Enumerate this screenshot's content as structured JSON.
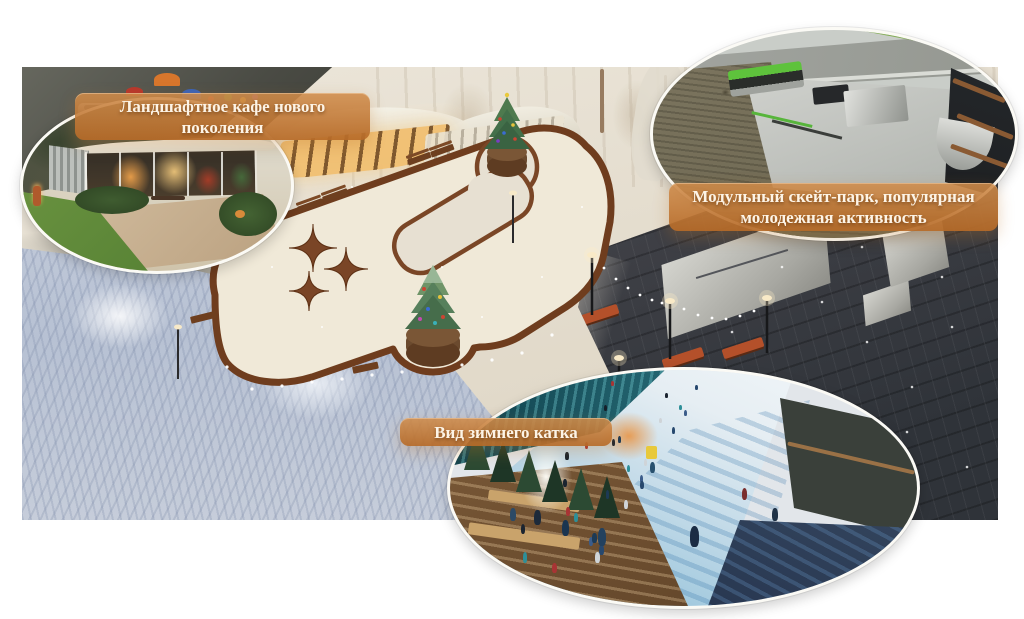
{
  "callouts": [
    {
      "id": "cafe",
      "label": "Ландшафтное кафе нового поколения"
    },
    {
      "id": "skatepark",
      "label": "Модульный скейт-парк, популярная молодежная активность"
    },
    {
      "id": "rink",
      "label": "Вид зимнего катка"
    }
  ],
  "palette": {
    "callout_top": "#d08c4a",
    "callout_bottom": "#b76b28",
    "callout_text": "#fdf4e6",
    "track_curb": "#6f3d1e",
    "ice": "#f0e9d8",
    "snow": "#e6dfd1",
    "plaza_dark": "#3f4147",
    "frost_blue": "#bcc6d6",
    "skater_colors": [
      "#1b2430",
      "#27486e",
      "#a83434",
      "#2e8f98",
      "#cfd4d8",
      "#15202b",
      "#3b5c8a",
      "#1d3a55"
    ]
  },
  "decor": {
    "rink_conifers": 6,
    "skaters_small": 30
  }
}
